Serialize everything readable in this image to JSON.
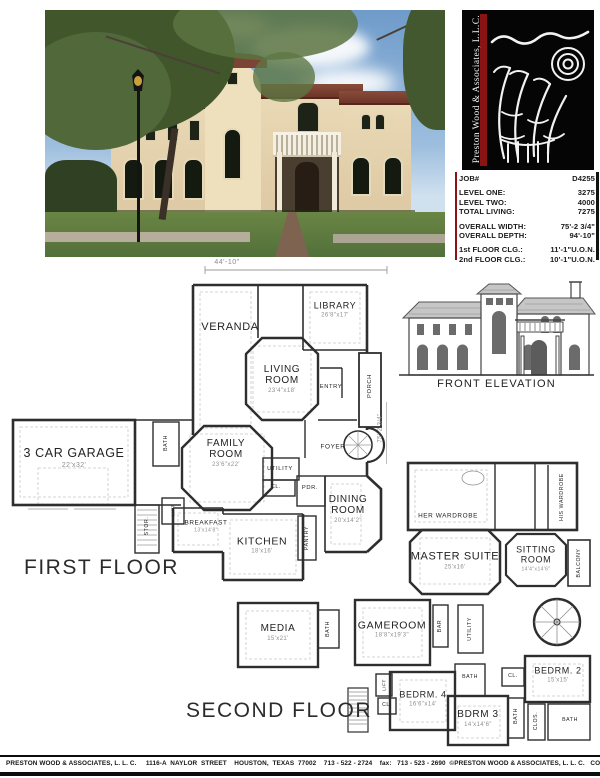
{
  "logo": {
    "company_vertical": "Preston Wood & Associates, L.L.C."
  },
  "job_info": {
    "rows": [
      {
        "label": "JOB#",
        "value": "D4255"
      },
      {
        "label": "LEVEL ONE:",
        "value": "3275"
      },
      {
        "label": "LEVEL TWO:",
        "value": "4000"
      },
      {
        "label": "TOTAL LIVING:",
        "value": "7275"
      },
      {
        "label": "OVERALL WIDTH:",
        "value": "75'-2 3/4\""
      },
      {
        "label": "OVERALL DEPTH:",
        "value": "94'-10\""
      },
      {
        "label": "1st FLOOR CLG.:",
        "value": "11'-1\"U.O.N."
      },
      {
        "label": "2nd FLOOR CLG.:",
        "value": "10'-1\"U.O.N."
      }
    ]
  },
  "first_floor": {
    "title": "FIRST FLOOR",
    "width_dim": "44'-10\"",
    "depth_dim": "75'-2 3/4\"",
    "rooms": {
      "veranda": {
        "name": "VERANDA"
      },
      "library": {
        "name": "LIBRARY",
        "dim": "26'8\"x17'"
      },
      "living": {
        "name": "LIVING ROOM",
        "dim": "23'4\"x18'"
      },
      "entry": {
        "name": "ENTRY"
      },
      "porch": {
        "name": "PORCH"
      },
      "family": {
        "name": "FAMILY ROOM",
        "dim": "23'6\"x22'"
      },
      "foyer": {
        "name": "FOYER"
      },
      "utility": {
        "name": "UTILITY"
      },
      "closet": {
        "name": "CL."
      },
      "powder": {
        "name": "PDR."
      },
      "dining": {
        "name": "DINING ROOM",
        "dim": "20'x14'2\""
      },
      "kitchen": {
        "name": "KITCHEN",
        "dim": "18'x16'"
      },
      "pantry": {
        "name": "PANTRY"
      },
      "breakfast": {
        "name": "BREAKFAST",
        "dim": "13'x14'8\""
      },
      "garage": {
        "name": "3 CAR GARAGE",
        "dim": "22'x32'"
      },
      "bath": {
        "name": "BATH"
      },
      "storage": {
        "name": "STOR."
      },
      "lift": {
        "name": "LIFT"
      }
    }
  },
  "second_floor": {
    "title": "SECOND FLOOR",
    "rooms": {
      "her_wardrobe": {
        "name": "HER WARDROBE"
      },
      "his_wardrobe": {
        "name": "HIS WARDROBE"
      },
      "master": {
        "name": "MASTER SUITE",
        "dim": "25'x16'"
      },
      "sitting": {
        "name": "SITTING ROOM",
        "dim": "14'4\"x14'6\""
      },
      "balcony": {
        "name": "BALCONY"
      },
      "media": {
        "name": "MEDIA",
        "dim": "15'x21'"
      },
      "bath_media": {
        "name": "BATH"
      },
      "gameroom": {
        "name": "GAMEROOM",
        "dim": "18'8\"x19'3\""
      },
      "bar": {
        "name": "BAR"
      },
      "utility": {
        "name": "UTILITY"
      },
      "lift": {
        "name": "LIFT"
      },
      "closet4": {
        "name": "CL."
      },
      "bedrm4": {
        "name": "BEDRM. 4",
        "dim": "16'6\"x14'"
      },
      "bath_mid": {
        "name": "BATH"
      },
      "closet2": {
        "name": "CL."
      },
      "bedrm2": {
        "name": "BEDRM. 2",
        "dim": "15'x15'"
      },
      "bdrm3": {
        "name": "BDRM 3",
        "dim": "14'x14'6\""
      },
      "bath3": {
        "name": "BATH"
      },
      "clos": {
        "name": "CLOS."
      },
      "bath_br": {
        "name": "BATH"
      }
    }
  },
  "elevation": {
    "label": "FRONT ELEVATION"
  },
  "footer": {
    "text": "PRESTON WOOD & ASSOCIATES, L. L. C.     1116-A  NAYLOR  STREET    HOUSTON,  TEXAS  77002    713 - 522 - 2724    fax:   713 - 523 - 2690  ©PRESTON WOOD & ASSOCIATES, L. L. C.   COPYRIGHT"
  }
}
